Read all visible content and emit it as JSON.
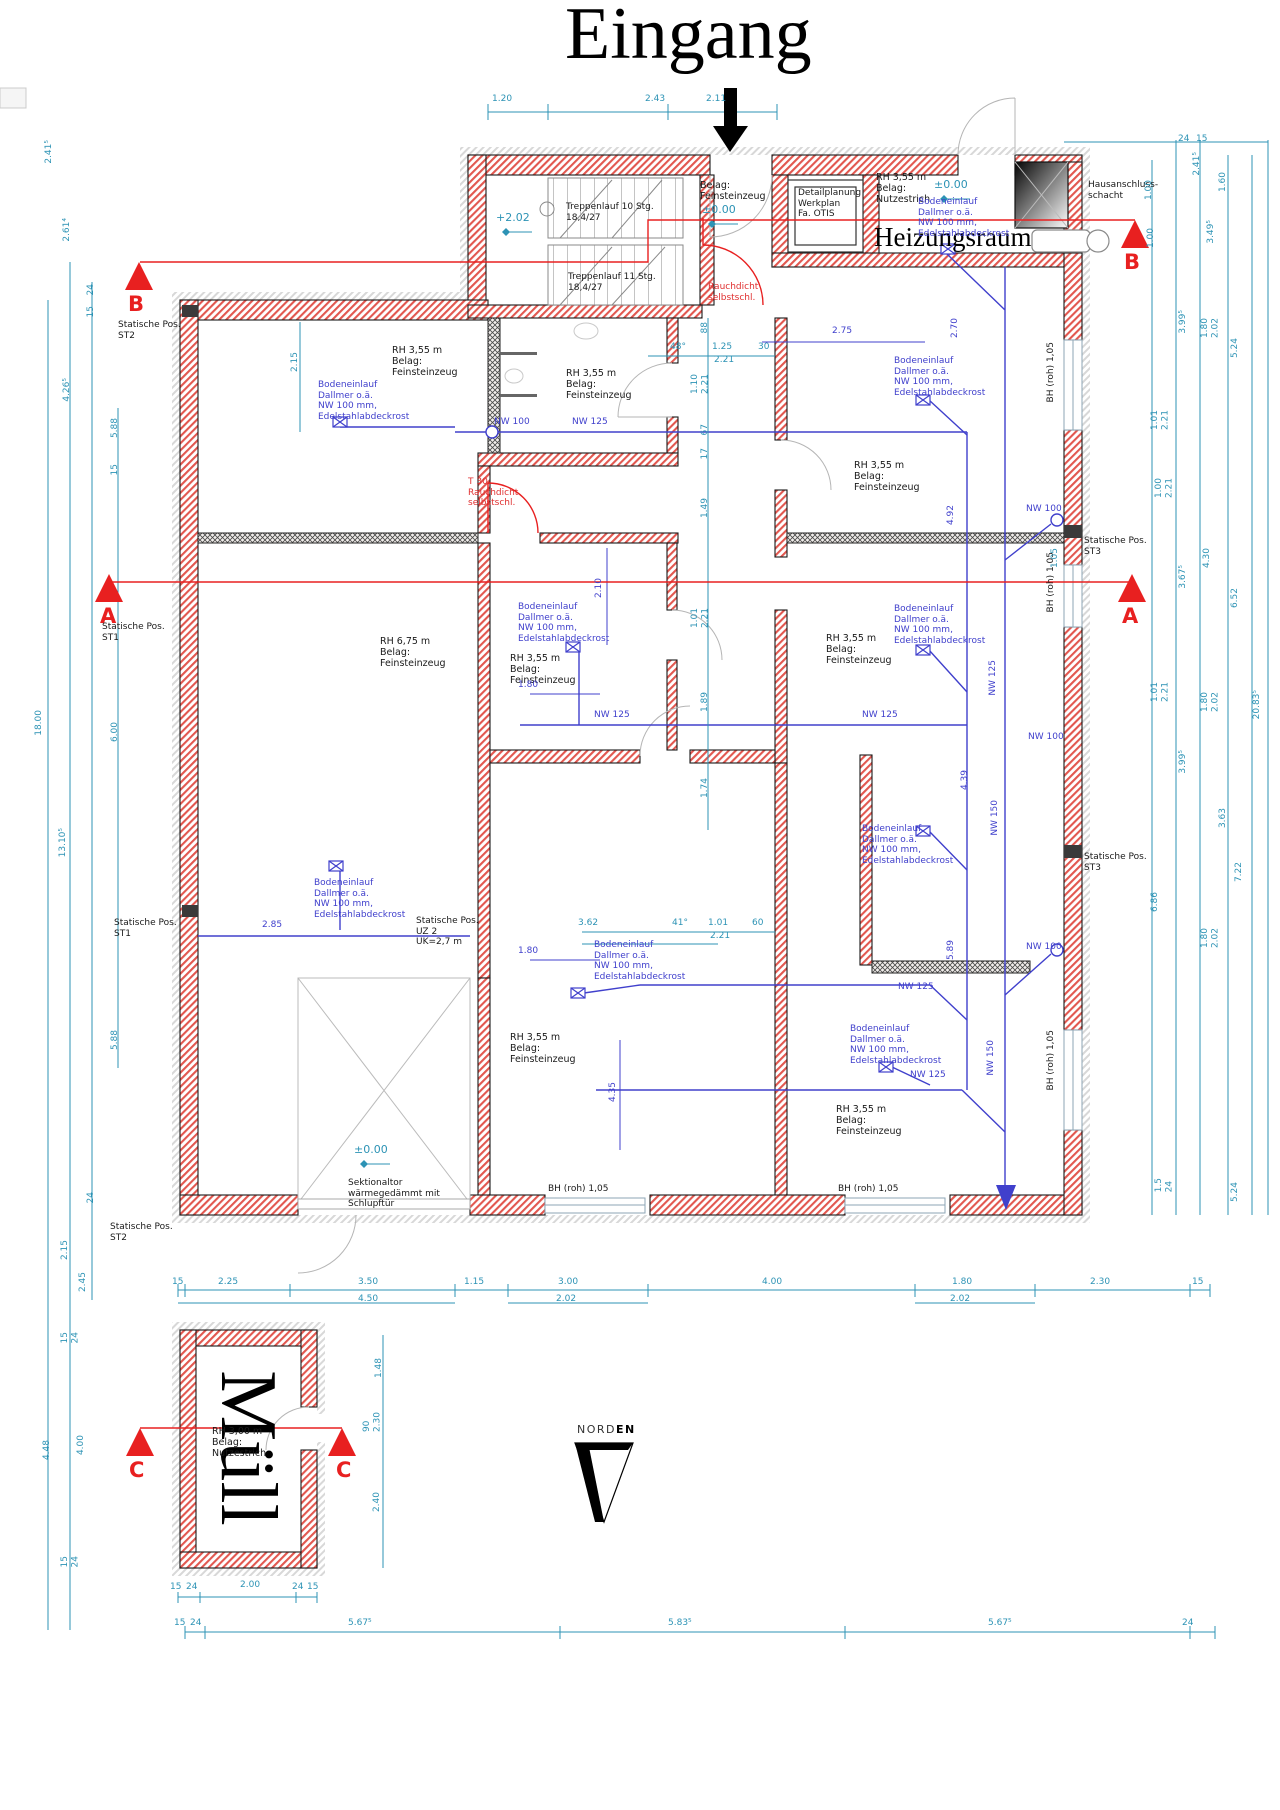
{
  "title": "Eingang",
  "rooms": {
    "heiz": "Heizungsraum",
    "muell": "Müll",
    "rh355fz": "RH 3,55 m\nBelag:\nFeinsteinzeug",
    "rh355nz": "RH 3,55 m\nBelag:\nNutzestrich",
    "rh675": "RH 6,75 m\nBelag:\nFeinsteinzeug",
    "rh300": "RH 3,00 m\nBelag:\nNutzestrich",
    "entry": "Belag:\nFeinsteinzeug"
  },
  "notes": {
    "t10": "Treppenlauf 10 Stg.\n18,4/27",
    "t11": "Treppenlauf 11 Stg.\n18,4/27",
    "otis": "Detailplanung\nWerkplan\nFa. OTIS",
    "haus": "Hausanschluss-\nschacht",
    "sek": "Sektionaltor\nwärmegedämmt mit\nSchlupftür",
    "rauch": "Rauchdicht\nselbstschl.",
    "t30": "T 30\nRauchdicht\nselbstschl.",
    "drain": "Bodeneinlauf\nDallmer o.ä.\nNW 100 mm,\nEdelstahlabdeckrost",
    "st1": "Statische Pos.\nST1",
    "st2": "Statische Pos.\nST2",
    "st3": "Statische Pos.\nST3",
    "uz2": "Statische Pos.\nUZ 2\nUK=2,7 m",
    "bh": "BH (roh) 1,05",
    "nord": "NORD",
    "en": "EN"
  },
  "levels": {
    "zero": "±0.00",
    "p202": "+2.02"
  },
  "pipes": {
    "nw100": "NW 100",
    "nw125": "NW 125",
    "nw150": "NW 150"
  },
  "sections": {
    "a": "A",
    "b": "B",
    "c": "C"
  },
  "dims": {
    "t1": "1.20",
    "t2": "2.43",
    "t3": "2.11",
    "l1": "2.41⁵",
    "l2": "2.61⁴",
    "l3": "24",
    "l4": "15",
    "l5": "4.26⁵",
    "l6": "5.88",
    "l7": "15",
    "l8": "18.00",
    "l9": "6.00",
    "l10": "13.10⁵",
    "l11": "5.88",
    "l12": "24",
    "l13": "2.15",
    "l14": "2.45",
    "l15": "4.48",
    "l16": "4.00",
    "l17": "15\n24",
    "l18": "15\n24",
    "r1": "24",
    "r2": "15",
    "r3": "2.41⁵",
    "r4": "1.00",
    "r5": "1.60",
    "r6": "3.49⁵",
    "r7": "3.99⁵",
    "r8": "1.80\n2.02",
    "r9": "5.24",
    "r10": "1.01\n2.21",
    "r11": "1.00\n2.21",
    "r12": "3.67⁵",
    "r13": "4.30",
    "r14": "6.52",
    "r15": "20.83⁵",
    "r16": "1.01\n2.21",
    "r17": "1.80\n2.02",
    "r18": "3.63",
    "r19": "7.22",
    "r20": "6.86",
    "r21": "1.80\n2.02",
    "r22": "1.5\n24",
    "r23": "5.24",
    "r24": "3.99⁵",
    "b1": "15",
    "b2": "2.25",
    "b3": "3.50",
    "b4": "4.50",
    "b5": "1.15",
    "b6": "3.00",
    "b7": "2.02",
    "b8": "4.00",
    "b9": "1.80",
    "b10": "2.02",
    "b11": "2.30",
    "b12": "15",
    "bb1": "15",
    "bb2": "24",
    "bb3": "5.67⁵",
    "bb4": "5.83⁵",
    "bb5": "5.67⁵",
    "bb6": "24",
    "m1": "1.48",
    "m2": "90\n2.30",
    "m3": "2.40",
    "m4": "15",
    "m5": "24",
    "m6": "2.00",
    "m7": "24",
    "m8": "15",
    "i1": "48°",
    "i2": "1.25",
    "i3": "30",
    "i4": "2.21",
    "i5": "88",
    "i6": "1.10\n2.21",
    "i7": "67",
    "i8": "17",
    "i9": "1.49",
    "i10": "1.01\n2.21",
    "i11": "1.89",
    "i12": "1.74",
    "i13": "3.62",
    "i14": "41°",
    "i15": "1.01",
    "i16": "60",
    "i17": "2.21",
    "i18": "2.15",
    "u1": "2.75",
    "u2": "2.70",
    "u3": "2.10",
    "u4": "1.80",
    "u5": "2.85",
    "u6": "1.80",
    "u7": "4.35",
    "u8": "4.92",
    "u9": "4.39",
    "u10": "5.89",
    "u11": "1.00",
    "u12": "1.05"
  }
}
